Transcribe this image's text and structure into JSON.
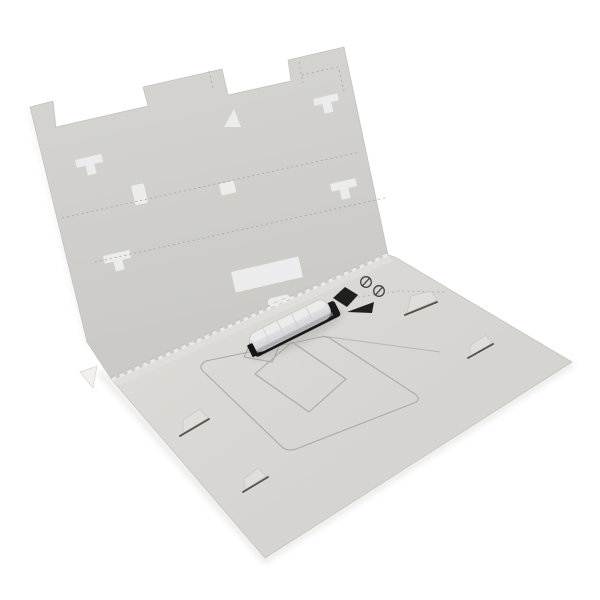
{
  "meta": {
    "description": "Opened light-grey die-cut cardboard packaging insert photographed on a white background; an upright back panel with cut-out slots stands behind a flat base panel that carries printed placement outlines, two black printed registration marks, two circled symbols and a small white plastic component with a black base resting diagonally on it."
  },
  "colors": {
    "background": "#ffffff",
    "panel_back": "#e7e6e3",
    "panel_back_deep": "#dbdad6",
    "panel_base": "#f0efeb",
    "panel_base_deep": "#e3e1dc",
    "cut_edge": "#cfcdc8",
    "crease_dot": "#b7b5b0",
    "print_outline": "#b9b7b1",
    "guide_line": "#c0beb9",
    "mark_black": "#232321",
    "icon_stroke": "#4a4845",
    "slit_dark": "#5b574f",
    "flap_light": "#f1f0ec",
    "fold_highlight": "#f4f3ef",
    "object_base": "#1c1c1c",
    "object_white_top": "#fbfbfd",
    "object_white_mid": "#f2f2f5",
    "object_white_deep": "#dcdce2",
    "object_highlight": "#ffffff",
    "object_rib": "#dddde4",
    "object_seam": "#a7a7ae",
    "shadow": "#bdbbb6"
  },
  "icons": [
    {
      "name": "circle-slash-icon-1"
    },
    {
      "name": "circle-slash-icon-2"
    },
    {
      "name": "black-diamond-mark"
    },
    {
      "name": "black-triangle-mark"
    }
  ]
}
